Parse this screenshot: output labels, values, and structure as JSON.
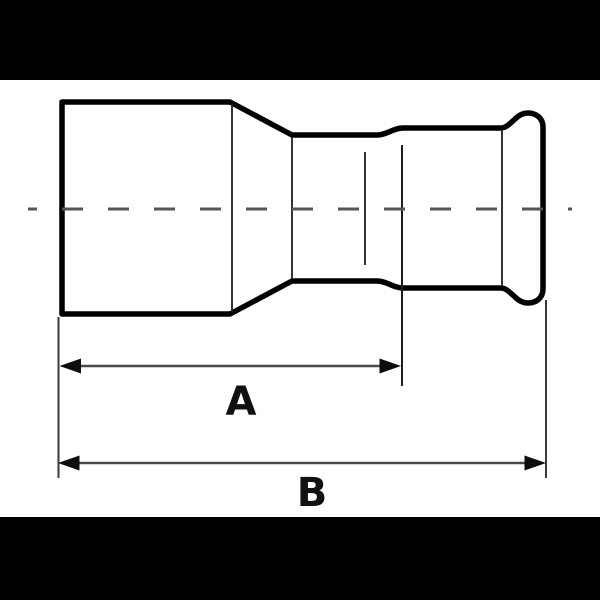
{
  "colors": {
    "background": "#ffffff",
    "letterbox": "#000000",
    "outline": "#000000",
    "inner_line": "#1d1d1d",
    "centerline": "#555555",
    "extension_line": "#3a3a3a",
    "dimension_line": "#4a4a4a",
    "arrowhead": "#0d0d0d",
    "label": "#111111"
  },
  "dimensions": {
    "a": {
      "label": "A"
    },
    "b": {
      "label": "B"
    }
  }
}
